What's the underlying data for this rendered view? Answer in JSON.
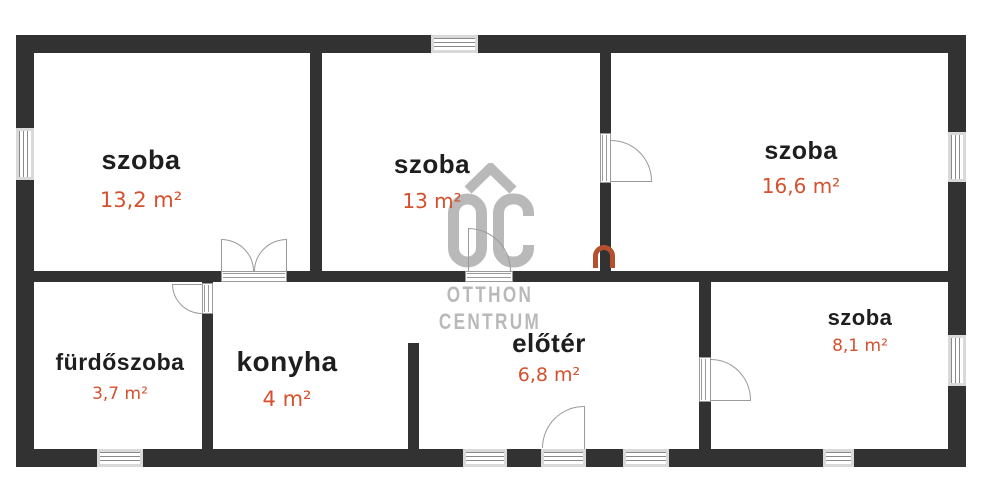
{
  "plan": {
    "rooms": [
      {
        "id": "szoba-1",
        "name": "szoba",
        "area": "13,2 m²"
      },
      {
        "id": "szoba-2",
        "name": "szoba",
        "area": "13 m²"
      },
      {
        "id": "szoba-3",
        "name": "szoba",
        "area": "16,6 m²"
      },
      {
        "id": "furdoszoba",
        "name": "fürdőszoba",
        "area": "3,7 m²"
      },
      {
        "id": "konyha",
        "name": "konyha",
        "area": "4 m²"
      },
      {
        "id": "eloter",
        "name": "előtér",
        "area": "6,8 m²"
      },
      {
        "id": "szoba-4",
        "name": "szoba",
        "area": "8,1 m²"
      }
    ],
    "watermark": {
      "logo": "OC",
      "line1": "OTTHON",
      "line2": "CENTRUM"
    },
    "colors": {
      "wall": "#323232",
      "accent_orange": "#d5502c",
      "watermark_gray": "#b9b9b9",
      "room_text": "#1e1e1e"
    }
  }
}
